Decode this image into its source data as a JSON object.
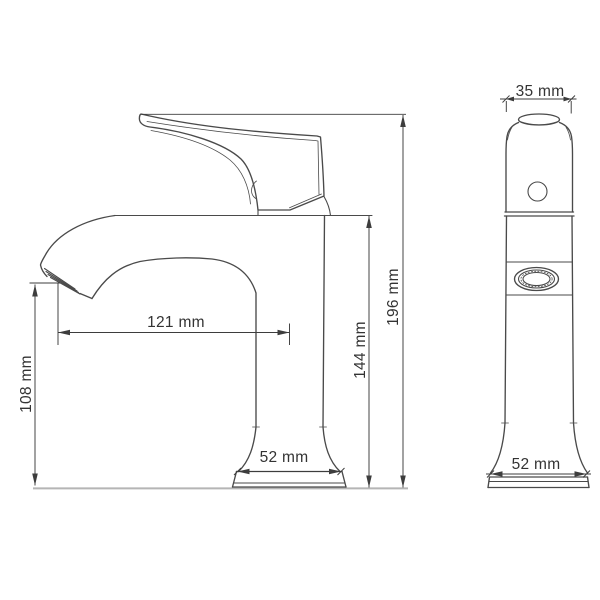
{
  "drawing": {
    "type": "technical-dimension-drawing",
    "subject": "single-handle basin faucet, side view and front view",
    "views": {
      "side": {
        "name": "side view"
      },
      "front": {
        "name": "front view"
      }
    },
    "dimensions": {
      "spout_reach": "121 mm",
      "outlet_height": "108 mm",
      "body_height": "144 mm",
      "total_height": "196 mm",
      "handle_width": "35 mm",
      "base_width_side": "52 mm",
      "base_width_front": "52 mm"
    },
    "colors": {
      "outline": "#4a4a4a",
      "dimension": "#3d3d3d",
      "ground": "#b5b5b5",
      "text": "#333333",
      "background": "#ffffff"
    }
  }
}
